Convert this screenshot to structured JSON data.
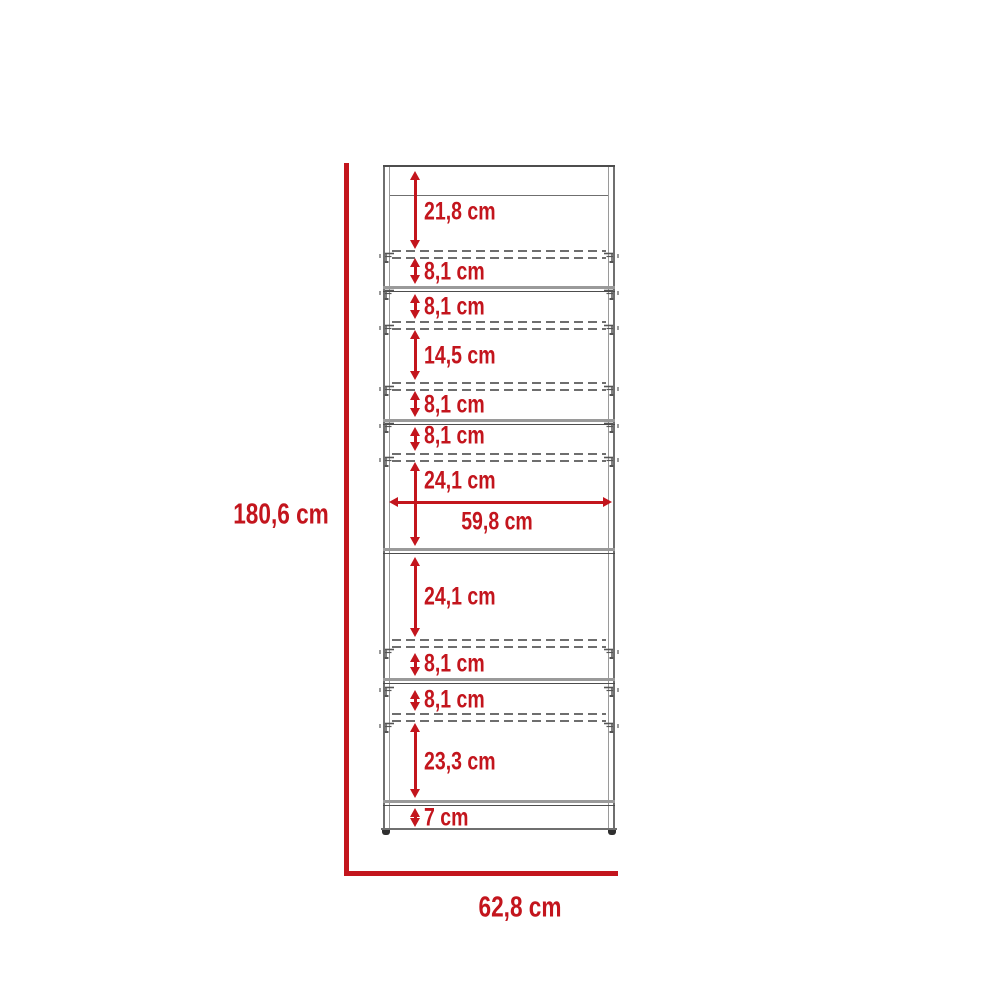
{
  "colors": {
    "red": "#c3151d",
    "line": "#6f6f6f",
    "line_light": "#9a9a9a",
    "line_dark": "#4d4d4d",
    "dash": "#6e6e6e",
    "foot": "#2f2f2f"
  },
  "overall": {
    "height_label": "180,6 cm",
    "width_label": "62,8 cm"
  },
  "horizontal_measurement": {
    "label": "59,8 cm",
    "y": 502,
    "x1": 389,
    "x2": 612,
    "label_x": 497,
    "label_y": 522
  },
  "vertical_measurements": [
    {
      "label": "21,8 cm",
      "y1": 171,
      "y2": 249,
      "label_y": 212
    },
    {
      "label": "8,1 cm",
      "y1": 258,
      "y2": 284,
      "label_y": 272
    },
    {
      "label": "8,1 cm",
      "y1": 294,
      "y2": 319,
      "label_y": 307
    },
    {
      "label": "14,5 cm",
      "y1": 330,
      "y2": 380,
      "label_y": 356
    },
    {
      "label": "8,1 cm",
      "y1": 391,
      "y2": 417,
      "label_y": 405
    },
    {
      "label": "8,1 cm",
      "y1": 427,
      "y2": 451,
      "label_y": 436
    },
    {
      "label": "24,1 cm",
      "y1": 462,
      "y2": 546,
      "label_y": 481
    },
    {
      "label": "24,1 cm",
      "y1": 557,
      "y2": 637,
      "label_y": 597
    },
    {
      "label": "8,1 cm",
      "y1": 653,
      "y2": 676,
      "label_y": 664
    },
    {
      "label": "8,1 cm",
      "y1": 690,
      "y2": 711,
      "label_y": 700
    },
    {
      "label": "23,3 cm",
      "y1": 723,
      "y2": 798,
      "label_y": 762
    },
    {
      "label": "7 cm",
      "y1": 808,
      "y2": 827,
      "label_y": 818
    }
  ],
  "geometry": {
    "cabinet": {
      "left": 383,
      "right": 615,
      "top": 165,
      "bottom": 830
    },
    "top_band_y": 195,
    "arrow_x": 415,
    "label_x": 424,
    "solid_shelves": [
      286,
      419,
      548,
      678,
      800
    ],
    "dashed_pairs": [
      250,
      321,
      382,
      453,
      639,
      713
    ],
    "pin_rows": [
      252,
      289,
      324,
      385,
      422,
      456,
      648,
      686,
      722
    ],
    "overall_dim_lines": {
      "v_x": 344,
      "v_y1": 163,
      "v_y2": 876,
      "h_y": 871,
      "h_x1": 344,
      "h_x2": 618
    },
    "overall_labels": {
      "height_x": 281,
      "height_y": 515,
      "width_x": 520,
      "width_y": 908
    }
  }
}
